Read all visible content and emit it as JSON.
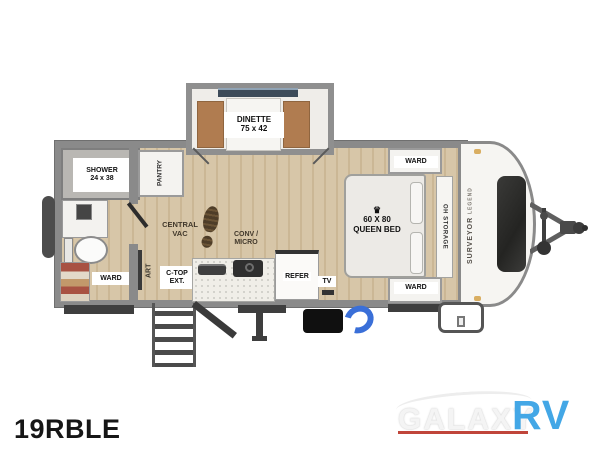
{
  "model": "19RBLE",
  "logo": {
    "galaxy": "GALAXY",
    "rv": "RV"
  },
  "cap_brand": {
    "primary": "SURVEYOR",
    "secondary": "LEGEND"
  },
  "labels": {
    "dinette_l1": "DINETTE",
    "dinette_l2": "75 x 42",
    "shower_l1": "SHOWER",
    "shower_l2": "24 x 38",
    "pantry": "PANTRY",
    "central_vac_l1": "CENTRAL",
    "central_vac_l2": "VAC",
    "conv_micro_l1": "CONV /",
    "conv_micro_l2": "MICRO",
    "ctop_l1": "C-TOP",
    "ctop_l2": "EXT.",
    "art": "ART",
    "ward_bath": "WARD",
    "ward_top": "WARD",
    "ward_bottom": "WARD",
    "oh_storage": "OH STORAGE",
    "refer": "REFER",
    "tv": "TV",
    "bed_crown": "♛",
    "bed_l1": "60 X 80",
    "bed_l2": "QUEEN BED"
  },
  "colors": {
    "floor_wood": "#d7c6a8",
    "floor_plank_line": "#cbb795",
    "wall_gray": "#8a8a8a",
    "bench_brown": "#b07c50",
    "logo_blue": "#43a7e6",
    "logo_underline_red": "#c0453a",
    "hose_blue": "#3a6fd8"
  }
}
